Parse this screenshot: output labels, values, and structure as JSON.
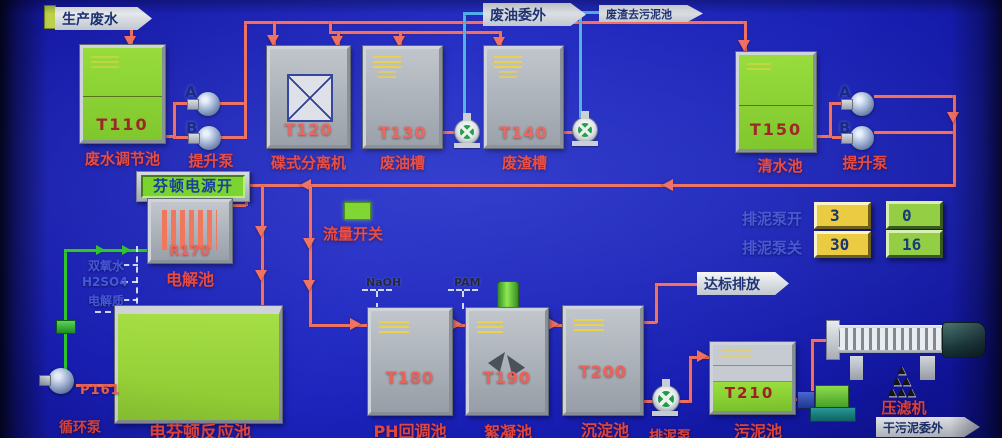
{
  "banners": {
    "production_wastewater": "生产废水",
    "waste_oil_outsourced": "废油委外",
    "residue_to_sludge": "废渣去污泥池",
    "compliant_discharge": "达标排放",
    "dry_sludge_outsourced": "干污泥委外"
  },
  "tanks": {
    "t110": {
      "id": "T110",
      "name": "废水调节池"
    },
    "t120": {
      "id": "T120",
      "name": "碟式分离机"
    },
    "t130": {
      "id": "T130",
      "name": "废油槽"
    },
    "t140": {
      "id": "T140",
      "name": "废渣槽"
    },
    "t150": {
      "id": "T150",
      "name": "清水池"
    },
    "r170": {
      "id": "R170",
      "name": "电解池"
    },
    "t180": {
      "id": "T180",
      "name": "PH回调池"
    },
    "t190": {
      "id": "T190",
      "name": "絮凝池"
    },
    "t200": {
      "id": "T200",
      "name": "沉淀池"
    },
    "t210": {
      "id": "T210",
      "name": "污泥池"
    },
    "fenton_reactor": {
      "name": "电芬顿反应池"
    }
  },
  "pumps": {
    "lift_pump_left": {
      "label": "提升泵",
      "pump_a": "A",
      "pump_b": "B"
    },
    "lift_pump_right": {
      "label": "提升泵",
      "pump_a": "A",
      "pump_b": "B"
    },
    "circulation_pump": {
      "id": "P161",
      "label": "循环泵"
    },
    "sludge_discharge_pump": {
      "label": "排泥泵"
    }
  },
  "controls": {
    "fenton_power_button": "芬顿电源开",
    "flow_switch_label": "流量开关",
    "sludge_pump_on": {
      "label": "排泥泵开",
      "setpoint": "3",
      "actual": "0"
    },
    "sludge_pump_off": {
      "label": "排泥泵关",
      "setpoint": "30",
      "actual": "16"
    }
  },
  "chemicals": {
    "hydrogen_peroxide": "双氧水",
    "sulfuric_acid": "H2SO4",
    "electrolyte": "电解质",
    "naoh": "NaOH",
    "pam": "PAM"
  },
  "equipment": {
    "filter_press": "压滤机"
  },
  "colors": {
    "background": "#161ab0",
    "pipe_red": "#ef6f60",
    "pipe_blue": "#4fb0e8",
    "pipe_green": "#2cc42c",
    "tank_green": "#8ad032",
    "label_red": "#e8473e",
    "label_blue": "#4456d8",
    "setpoint_bg": "#eaca3e",
    "actual_bg": "#93cd42"
  }
}
